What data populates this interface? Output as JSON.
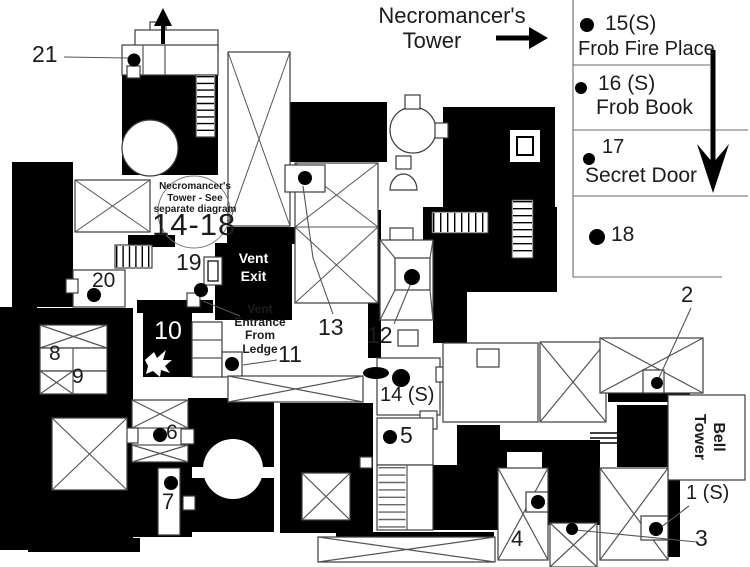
{
  "header": {
    "line1": "Necromancer's",
    "line2": "Tower"
  },
  "legend": {
    "items": [
      {
        "num": "15(S)",
        "desc": "Frob Fire Place"
      },
      {
        "num": "16 (S)",
        "desc": "Frob Book"
      },
      {
        "num": "17",
        "desc": "Secret Door"
      },
      {
        "num": "18",
        "desc": ""
      }
    ]
  },
  "annotations": {
    "tower_note": "Necromancer's\nTower - See\nseparate diagram",
    "tower_range": "14-18",
    "vent_exit": "Vent\nExit",
    "vent_entrance": "Vent\nEntrance\nFrom\nLedge",
    "bell_tower": "Bell\nTower"
  },
  "markers": {
    "n1": "1 (S)",
    "n2": "2",
    "n3": "3",
    "n4": "4",
    "n5": "5",
    "n6": "6",
    "n7": "7",
    "n8": "8",
    "n9": "9",
    "n10": "10",
    "n11": "11",
    "n12": "12",
    "n13": "13",
    "n14": "14 (S)",
    "n19": "19",
    "n20": "20",
    "n21": "21"
  },
  "colors": {
    "wall": "#000000",
    "floor": "#ffffff",
    "line": "#4a4a4a"
  }
}
